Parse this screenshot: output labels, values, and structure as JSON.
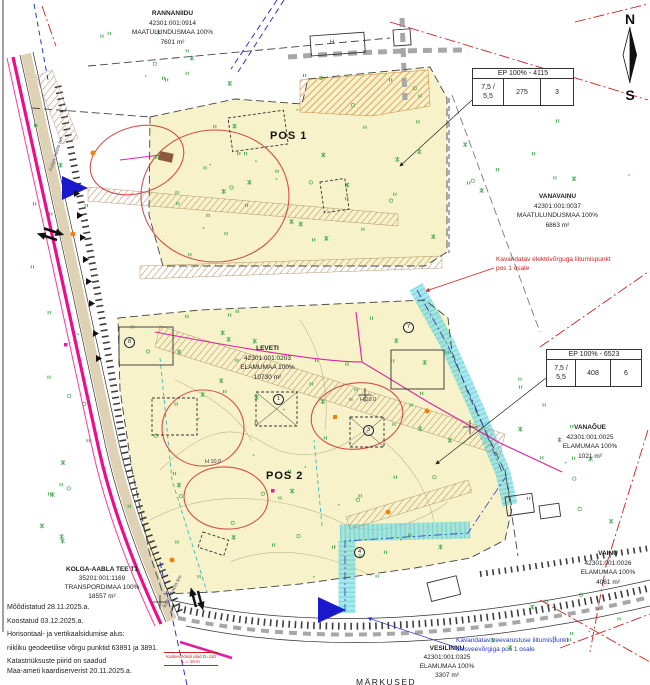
{
  "parcels": [
    {
      "name": "RANNANIIDU",
      "code": "42301:001:0914",
      "use": "MAATULUNDUSMAA 100%",
      "area": "7601 m²"
    },
    {
      "name": "VANAVAINU",
      "code": "42301:001:0037",
      "use": "MAATULUNDUSMAA 100%",
      "area": "6863 m²"
    },
    {
      "name": "LEVETI",
      "code": "42301:001:0203",
      "use": "ELAMUMAA 100%",
      "area": "10730 m²"
    },
    {
      "name": "VANAÕUE",
      "code": "42301:001:0025",
      "use": "ELAMUMAA 100%",
      "area": "1021 m²"
    },
    {
      "name": "VAINU",
      "code": "42301:001:0026",
      "use": "ELAMUMAA 100%",
      "area": "4061 m²"
    },
    {
      "name": "KOLGA-AABLA TEE T1",
      "code": "35201:001:1169",
      "use": "TRANSPORDIMAA 100%",
      "area": "18557 m²"
    },
    {
      "name": "VESILINNU",
      "code": "42301:001:0325",
      "use": "ELAMUMAA 100%",
      "area": "3307 m²"
    }
  ],
  "pos_labels": {
    "pos1": "POS 1",
    "pos2": "POS 2"
  },
  "tables": [
    {
      "header": "EP 100% - 4115",
      "height": "7,5 /",
      "height2": "5,5",
      "area": "275",
      "count": "3"
    },
    {
      "header": "EP 100% - 6523",
      "height": "7,5 /",
      "height2": "5,5",
      "area": "408",
      "count": "6"
    }
  ],
  "compass": {
    "n": "N",
    "s": "S"
  },
  "notes": [
    "Mõõdistatud  28.11.2025.a.",
    "Koostatud 03.12.2025.a.",
    "Horisontaal- ja vertikaalsidumise alus:",
    "riikliku geodeetilise võrgu punktid 63891 ja 3891.",
    "Katastriüksuste piirid on saadud",
    "Maa-ameti kaardiserverist 20.11.2025.a."
  ],
  "annotations": {
    "electric1": "Kavandatav elektrivõrguga liitumispunkt",
    "electric2": "pos 1 osale",
    "water1": "Kavandatav veevarustuse liitumispunkt",
    "water2": "ühisveevõrgiga pos 1 osale",
    "protection1": "Kaitsevööndi alad D=110",
    "protection2": "L = 10 m",
    "footer": "MÄRKUSED",
    "road_name": "Kolga-Aabla tee",
    "h_label": "H",
    "h10": "H 10.0"
  },
  "circled_numbers": [
    {
      "n": "8"
    },
    {
      "n": "3"
    },
    {
      "n": "4"
    },
    {
      "n": "7"
    },
    {
      "n": "1"
    }
  ],
  "colors": {
    "parcel_fill": "#f7f2c9",
    "road_magenta": "#ec0c8c",
    "corridor_cyan": "#72dbe4",
    "annotation_red": "#cc2222",
    "annotation_blue": "#2936c8",
    "vegetation_green": "#2f9e3f",
    "driveway_hatch": "#b98d62"
  }
}
